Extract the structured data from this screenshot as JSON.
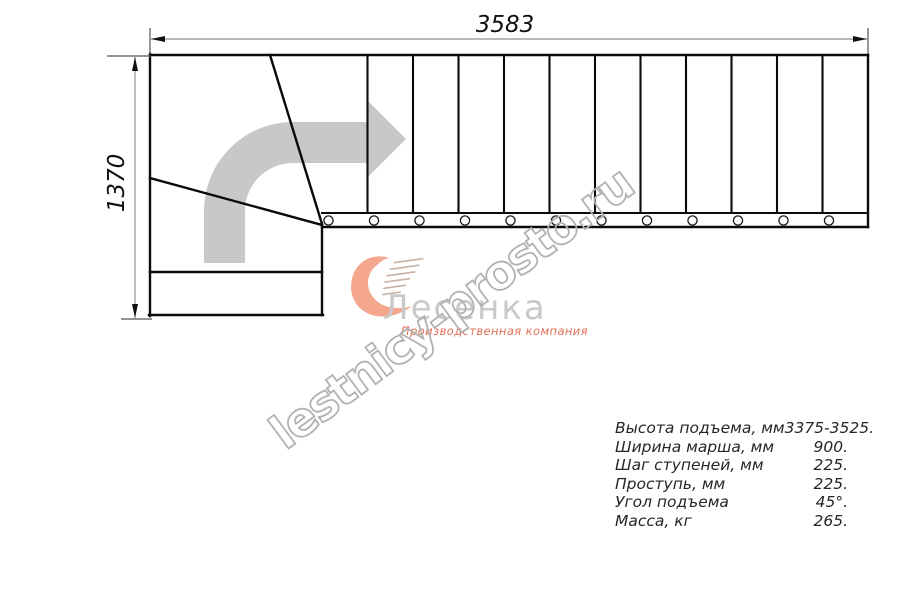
{
  "title": "План лестницы (чертёж)",
  "dimensions": {
    "width_mm": "3583",
    "height_mm": "1370"
  },
  "drawing": {
    "straight_flight": {
      "treads": 12,
      "baluster_circles": 12
    },
    "arrow_color": "#c8c8c8",
    "line_color": "#0a0a0a",
    "dim_line_color": "#8f8f8f"
  },
  "logo": {
    "name": "Лесенка",
    "tagline": "Производственная компания",
    "name_color": "#c9c9c9",
    "tagline_color": "#e4705a",
    "heart_color": "#f4a78c",
    "speedline_color": "#c9b2a5"
  },
  "watermark": {
    "text": "lestnicy-prosto.ru",
    "color": "#b2b2b2"
  },
  "specs": {
    "rows": [
      {
        "label": "Высота подъема, мм",
        "value": "3375-3525."
      },
      {
        "label": "Ширина марша, мм",
        "value": "900."
      },
      {
        "label": "Шаг ступеней, мм",
        "value": "225."
      },
      {
        "label": "Проступь, мм",
        "value": "225."
      },
      {
        "label": "Угол подъема",
        "value": "45°."
      },
      {
        "label": "Масса, кг",
        "value": "265."
      }
    ]
  }
}
